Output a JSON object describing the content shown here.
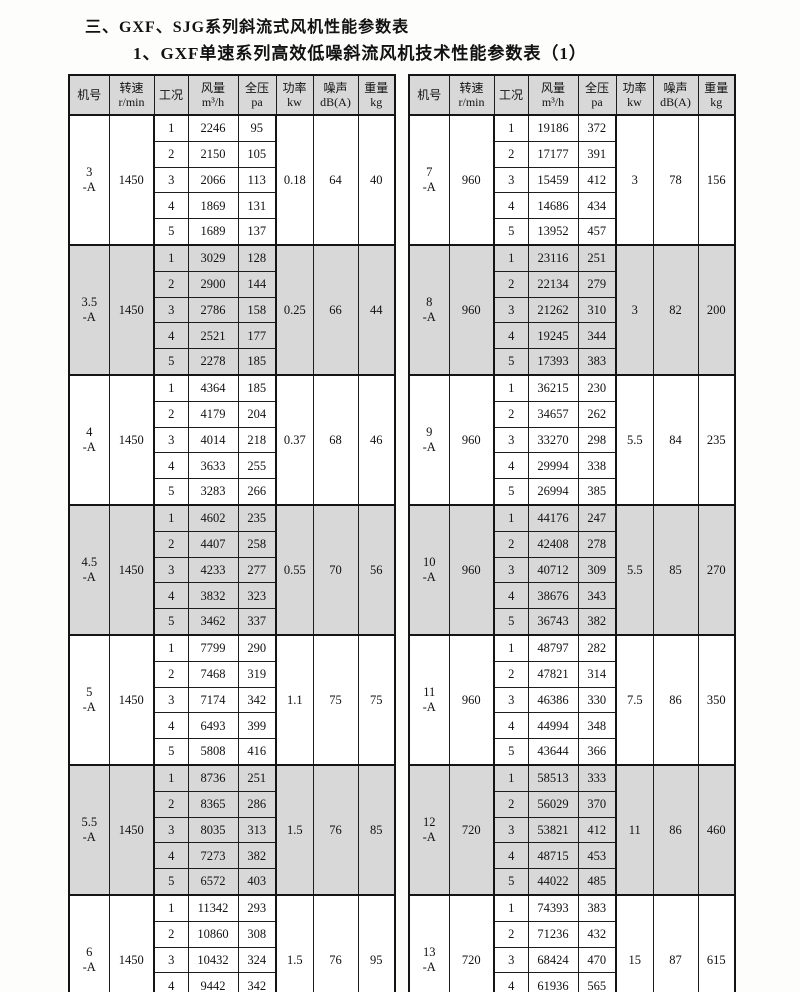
{
  "page": {
    "title1": "三、GXF、SJG系列斜流式风机性能参数表",
    "title2": "1、GXF单速系列高效低噪斜流风机技术性能参数表（1）"
  },
  "colors": {
    "shaded_block_bg": "#d8d8d8",
    "border": "#141414",
    "text": "#111111"
  },
  "headers": [
    {
      "l1": "机号",
      "l2": ""
    },
    {
      "l1": "转速",
      "l2": "r/min"
    },
    {
      "l1": "工况",
      "l2": ""
    },
    {
      "l1": "风量",
      "l2": "m³/h"
    },
    {
      "l1": "全压",
      "l2": "pa"
    },
    {
      "l1": "功率",
      "l2": "kw"
    },
    {
      "l1": "噪声",
      "l2": "dB(A)"
    },
    {
      "l1": "重量",
      "l2": "kg"
    }
  ],
  "tables": [
    {
      "side": "left",
      "blocks": [
        {
          "model_no": "3",
          "model_suffix": "-A",
          "speed": "1450",
          "shaded": false,
          "power": "0.18",
          "noise": "64",
          "weight": "40",
          "conditions": [
            {
              "no": "1",
              "flow": "2246",
              "pressure": "95"
            },
            {
              "no": "2",
              "flow": "2150",
              "pressure": "105"
            },
            {
              "no": "3",
              "flow": "2066",
              "pressure": "113"
            },
            {
              "no": "4",
              "flow": "1869",
              "pressure": "131"
            },
            {
              "no": "5",
              "flow": "1689",
              "pressure": "137"
            }
          ]
        },
        {
          "model_no": "3.5",
          "model_suffix": "-A",
          "speed": "1450",
          "shaded": true,
          "power": "0.25",
          "noise": "66",
          "weight": "44",
          "conditions": [
            {
              "no": "1",
              "flow": "3029",
              "pressure": "128"
            },
            {
              "no": "2",
              "flow": "2900",
              "pressure": "144"
            },
            {
              "no": "3",
              "flow": "2786",
              "pressure": "158"
            },
            {
              "no": "4",
              "flow": "2521",
              "pressure": "177"
            },
            {
              "no": "5",
              "flow": "2278",
              "pressure": "185"
            }
          ]
        },
        {
          "model_no": "4",
          "model_suffix": "-A",
          "speed": "1450",
          "shaded": false,
          "power": "0.37",
          "noise": "68",
          "weight": "46",
          "conditions": [
            {
              "no": "1",
              "flow": "4364",
              "pressure": "185"
            },
            {
              "no": "2",
              "flow": "4179",
              "pressure": "204"
            },
            {
              "no": "3",
              "flow": "4014",
              "pressure": "218"
            },
            {
              "no": "4",
              "flow": "3633",
              "pressure": "255"
            },
            {
              "no": "5",
              "flow": "3283",
              "pressure": "266"
            }
          ]
        },
        {
          "model_no": "4.5",
          "model_suffix": "-A",
          "speed": "1450",
          "shaded": true,
          "power": "0.55",
          "noise": "70",
          "weight": "56",
          "conditions": [
            {
              "no": "1",
              "flow": "4602",
              "pressure": "235"
            },
            {
              "no": "2",
              "flow": "4407",
              "pressure": "258"
            },
            {
              "no": "3",
              "flow": "4233",
              "pressure": "277"
            },
            {
              "no": "4",
              "flow": "3832",
              "pressure": "323"
            },
            {
              "no": "5",
              "flow": "3462",
              "pressure": "337"
            }
          ]
        },
        {
          "model_no": "5",
          "model_suffix": "-A",
          "speed": "1450",
          "shaded": false,
          "power": "1.1",
          "noise": "75",
          "weight": "75",
          "conditions": [
            {
              "no": "1",
              "flow": "7799",
              "pressure": "290"
            },
            {
              "no": "2",
              "flow": "7468",
              "pressure": "319"
            },
            {
              "no": "3",
              "flow": "7174",
              "pressure": "342"
            },
            {
              "no": "4",
              "flow": "6493",
              "pressure": "399"
            },
            {
              "no": "5",
              "flow": "5808",
              "pressure": "416"
            }
          ]
        },
        {
          "model_no": "5.5",
          "model_suffix": "-A",
          "speed": "1450",
          "shaded": true,
          "power": "1.5",
          "noise": "76",
          "weight": "85",
          "conditions": [
            {
              "no": "1",
              "flow": "8736",
              "pressure": "251"
            },
            {
              "no": "2",
              "flow": "8365",
              "pressure": "286"
            },
            {
              "no": "3",
              "flow": "8035",
              "pressure": "313"
            },
            {
              "no": "4",
              "flow": "7273",
              "pressure": "382"
            },
            {
              "no": "5",
              "flow": "6572",
              "pressure": "403"
            }
          ]
        },
        {
          "model_no": "6",
          "model_suffix": "-A",
          "speed": "1450",
          "shaded": false,
          "power": "1.5",
          "noise": "76",
          "weight": "95",
          "conditions": [
            {
              "no": "1",
              "flow": "11342",
              "pressure": "293"
            },
            {
              "no": "2",
              "flow": "10860",
              "pressure": "308"
            },
            {
              "no": "3",
              "flow": "10432",
              "pressure": "324"
            },
            {
              "no": "4",
              "flow": "9442",
              "pressure": "342"
            },
            {
              "no": "5",
              "flow": "8533",
              "pressure": "360"
            }
          ]
        }
      ]
    },
    {
      "side": "right",
      "blocks": [
        {
          "model_no": "7",
          "model_suffix": "-A",
          "speed": "960",
          "shaded": false,
          "power": "3",
          "noise": "78",
          "weight": "156",
          "conditions": [
            {
              "no": "1",
              "flow": "19186",
              "pressure": "372"
            },
            {
              "no": "2",
              "flow": "17177",
              "pressure": "391"
            },
            {
              "no": "3",
              "flow": "15459",
              "pressure": "412"
            },
            {
              "no": "4",
              "flow": "14686",
              "pressure": "434"
            },
            {
              "no": "5",
              "flow": "13952",
              "pressure": "457"
            }
          ]
        },
        {
          "model_no": "8",
          "model_suffix": "-A",
          "speed": "960",
          "shaded": true,
          "power": "3",
          "noise": "82",
          "weight": "200",
          "conditions": [
            {
              "no": "1",
              "flow": "23116",
              "pressure": "251"
            },
            {
              "no": "2",
              "flow": "22134",
              "pressure": "279"
            },
            {
              "no": "3",
              "flow": "21262",
              "pressure": "310"
            },
            {
              "no": "4",
              "flow": "19245",
              "pressure": "344"
            },
            {
              "no": "5",
              "flow": "17393",
              "pressure": "383"
            }
          ]
        },
        {
          "model_no": "9",
          "model_suffix": "-A",
          "speed": "960",
          "shaded": false,
          "power": "5.5",
          "noise": "84",
          "weight": "235",
          "conditions": [
            {
              "no": "1",
              "flow": "36215",
              "pressure": "230"
            },
            {
              "no": "2",
              "flow": "34657",
              "pressure": "262"
            },
            {
              "no": "3",
              "flow": "33270",
              "pressure": "298"
            },
            {
              "no": "4",
              "flow": "29994",
              "pressure": "338"
            },
            {
              "no": "5",
              "flow": "26994",
              "pressure": "385"
            }
          ]
        },
        {
          "model_no": "10",
          "model_suffix": "-A",
          "speed": "960",
          "shaded": true,
          "power": "5.5",
          "noise": "85",
          "weight": "270",
          "conditions": [
            {
              "no": "1",
              "flow": "44176",
              "pressure": "247"
            },
            {
              "no": "2",
              "flow": "42408",
              "pressure": "278"
            },
            {
              "no": "3",
              "flow": "40712",
              "pressure": "309"
            },
            {
              "no": "4",
              "flow": "38676",
              "pressure": "343"
            },
            {
              "no": "5",
              "flow": "36743",
              "pressure": "382"
            }
          ]
        },
        {
          "model_no": "11",
          "model_suffix": "-A",
          "speed": "960",
          "shaded": false,
          "power": "7.5",
          "noise": "86",
          "weight": "350",
          "conditions": [
            {
              "no": "1",
              "flow": "48797",
              "pressure": "282"
            },
            {
              "no": "2",
              "flow": "47821",
              "pressure": "314"
            },
            {
              "no": "3",
              "flow": "46386",
              "pressure": "330"
            },
            {
              "no": "4",
              "flow": "44994",
              "pressure": "348"
            },
            {
              "no": "5",
              "flow": "43644",
              "pressure": "366"
            }
          ]
        },
        {
          "model_no": "12",
          "model_suffix": "-A",
          "speed": "720",
          "shaded": true,
          "power": "11",
          "noise": "86",
          "weight": "460",
          "conditions": [
            {
              "no": "1",
              "flow": "58513",
              "pressure": "333"
            },
            {
              "no": "2",
              "flow": "56029",
              "pressure": "370"
            },
            {
              "no": "3",
              "flow": "53821",
              "pressure": "412"
            },
            {
              "no": "4",
              "flow": "48715",
              "pressure": "453"
            },
            {
              "no": "5",
              "flow": "44022",
              "pressure": "485"
            }
          ]
        },
        {
          "model_no": "13",
          "model_suffix": "-A",
          "speed": "720",
          "shaded": false,
          "power": "15",
          "noise": "87",
          "weight": "615",
          "conditions": [
            {
              "no": "1",
              "flow": "74393",
              "pressure": "383"
            },
            {
              "no": "2",
              "flow": "71236",
              "pressure": "432"
            },
            {
              "no": "3",
              "flow": "68424",
              "pressure": "470"
            },
            {
              "no": "4",
              "flow": "61936",
              "pressure": "565"
            },
            {
              "no": "5",
              "flow": "55971",
              "pressure": "593"
            }
          ]
        }
      ]
    }
  ]
}
